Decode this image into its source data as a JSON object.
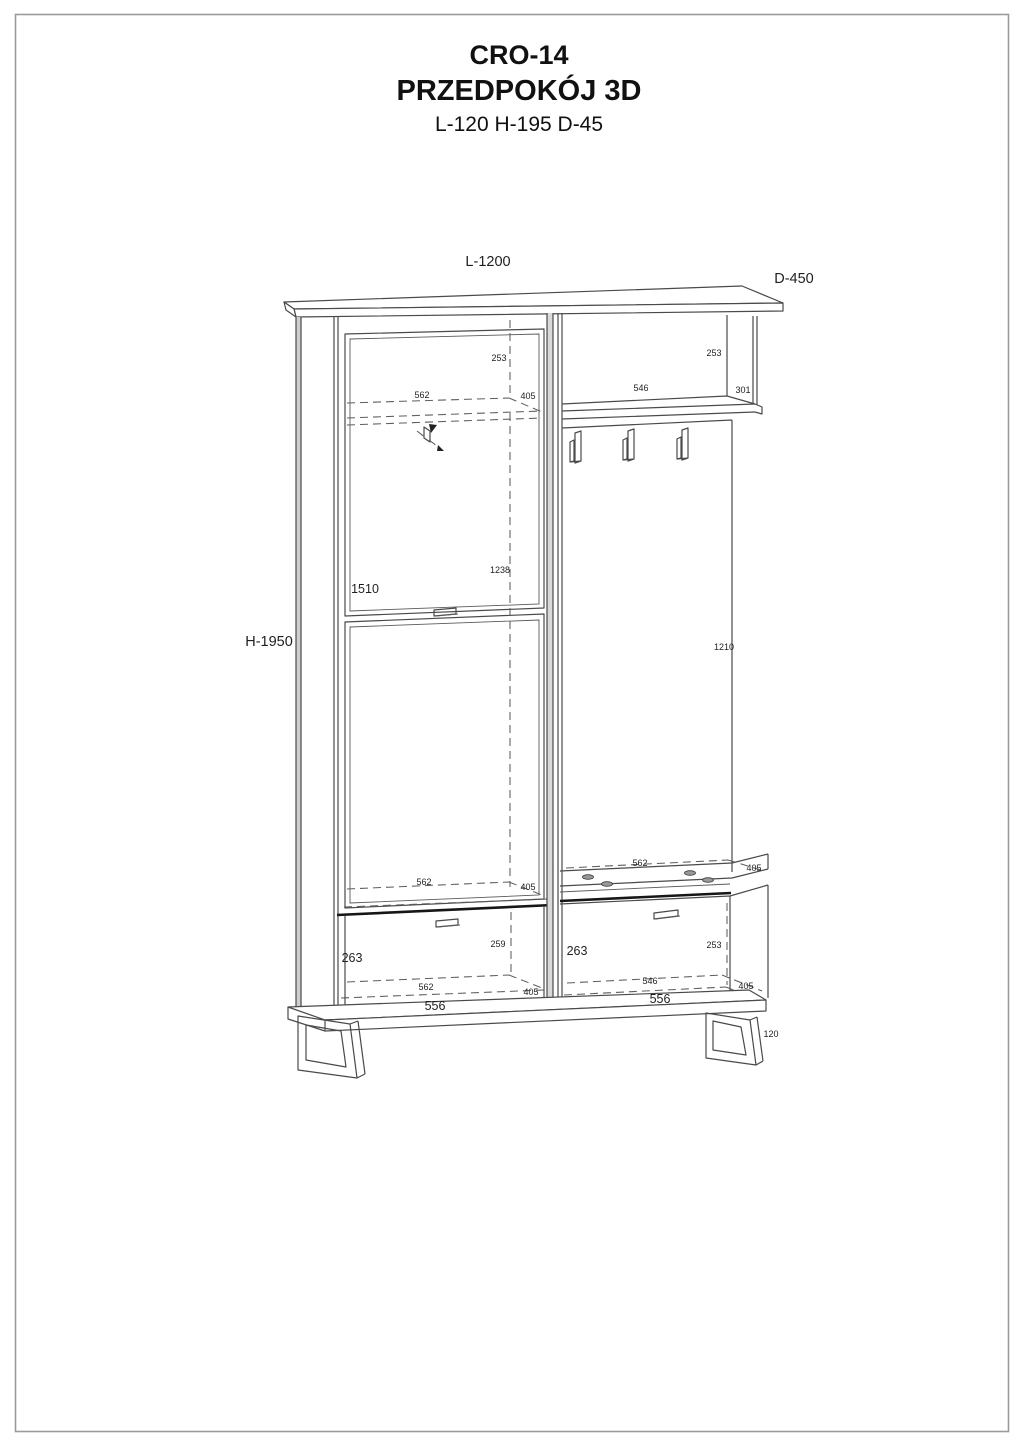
{
  "title": {
    "model": "CRO-14",
    "name": "PRZEDPOKÓJ 3D",
    "size": "L-120 H-195 D-45"
  },
  "colors": {
    "line": "#4a4a4a",
    "dark_line": "#161616",
    "text": "#1f1f1f",
    "background": "#ffffff"
  },
  "labels": {
    "overall_length": "L-1200",
    "overall_depth": "D-450",
    "overall_height": "H-1950",
    "left_top_offset": "253",
    "left_shelf_width": "562",
    "left_shelf_depth": "405",
    "shelf_box_height": "253",
    "shelf_box_width": "546",
    "shelf_box_depth": "301",
    "left_interior_height": "1238",
    "door_height": "1510",
    "panel_height": "1210",
    "left_floor_width": "562",
    "left_floor_depth": "405",
    "left_drawer_inner_depth": "259",
    "left_drawer_height": "263",
    "left_drawer_bottom_width": "562",
    "left_drawer_bottom_depth": "405",
    "left_front_width": "556",
    "bench_top_width": "562",
    "bench_top_depth": "405",
    "bench_height": "263",
    "bench_inner_height": "253",
    "bench_bottom_width": "546",
    "bench_bottom_depth": "405",
    "bench_front_width": "556",
    "base_height": "120"
  }
}
